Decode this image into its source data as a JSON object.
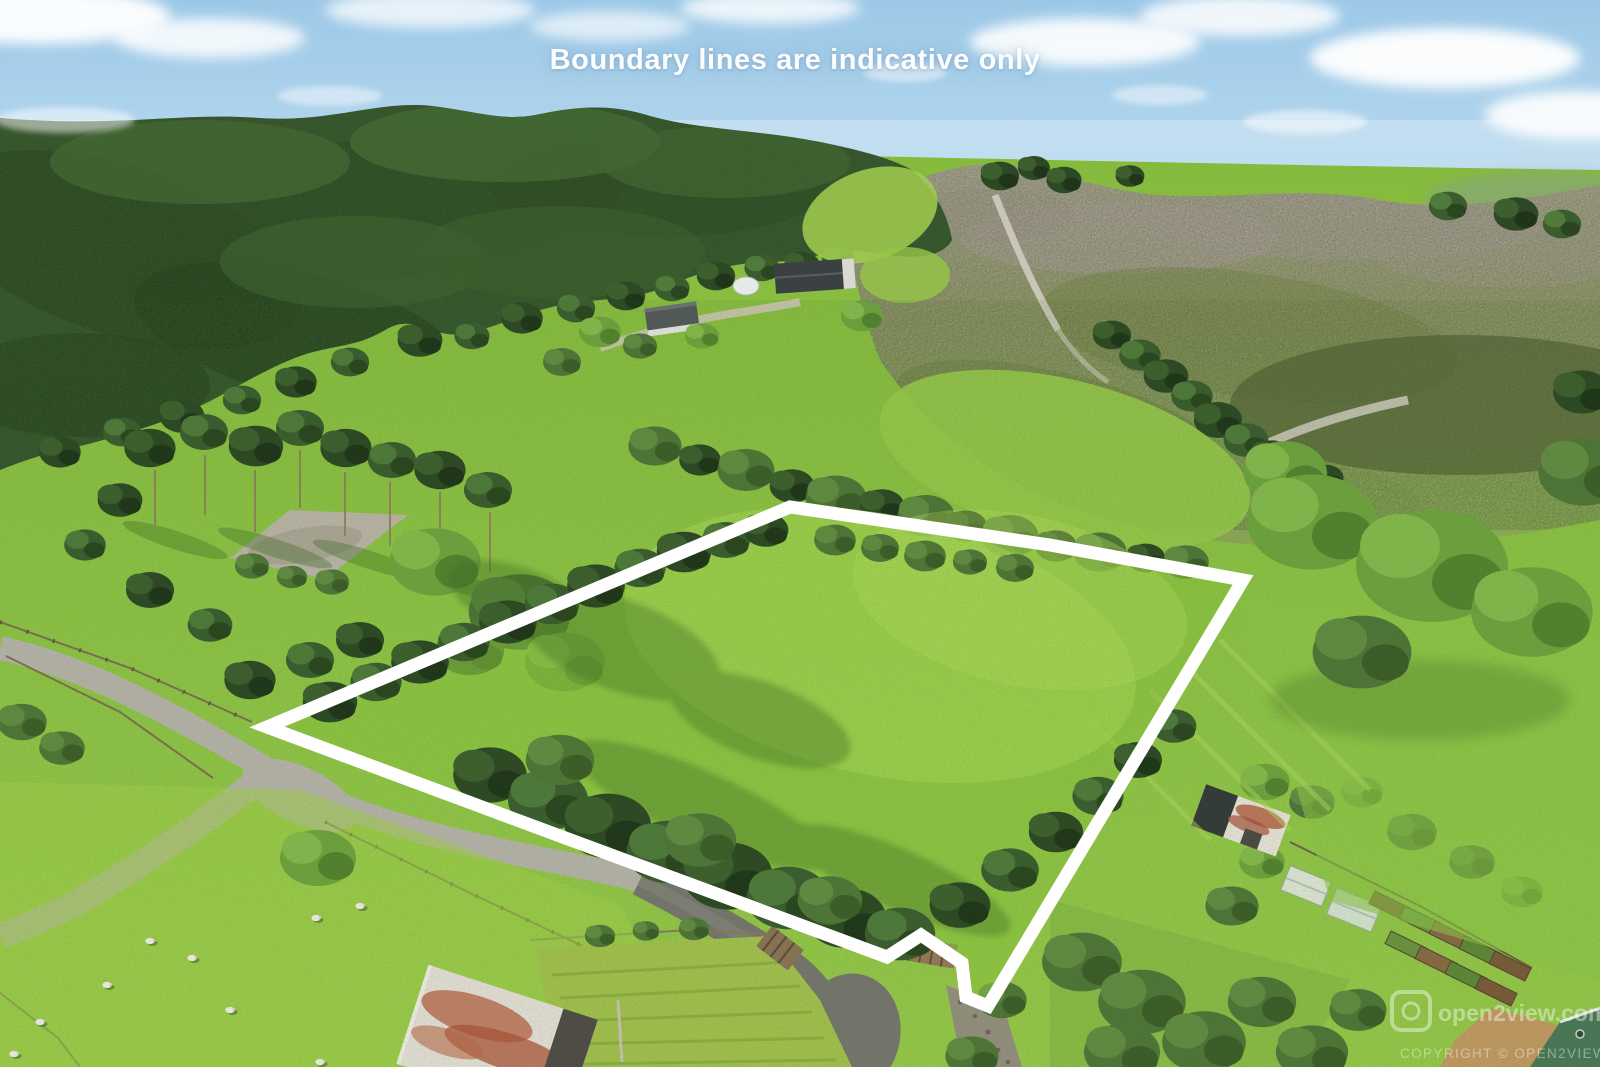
{
  "overlay": {
    "caption": "Boundary lines are indicative only",
    "watermark": {
      "logo_text": "open2view.com",
      "copyright": "COPYRIGHT © OPEN2VIEW.COM"
    }
  },
  "boundary": {
    "points": "267,727 790,507 1050,545 1243,580 988,1006 966,997 962,963 921,935 887,957 560,836",
    "color": "#ffffff",
    "stroke_width": "13"
  },
  "palette": {
    "sky": "#a5cde9",
    "cloud": "#ffffff",
    "forest": "#33512b",
    "pasture": "#8ec441",
    "lawn_sunlit": "#a8d551",
    "scrub_hill": "#9a9a74",
    "road_gravel": "#b8b4ab",
    "driveway_dark": "#77766f",
    "roof_rust": "#b4593b",
    "roof_green": "#4a7857",
    "boundary_line": "#ffffff"
  }
}
